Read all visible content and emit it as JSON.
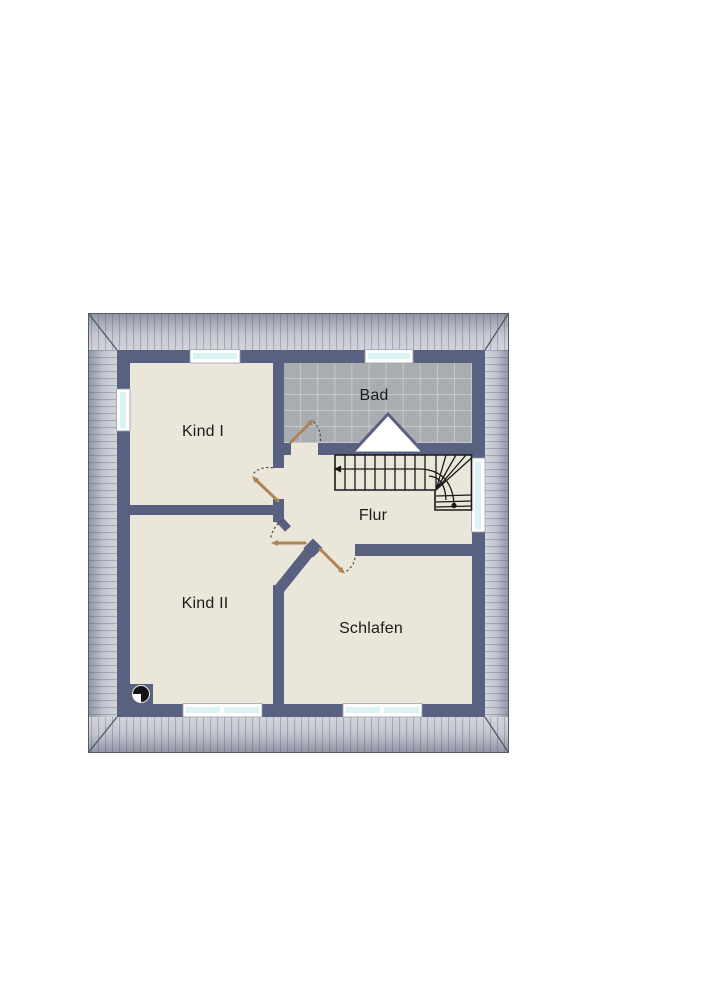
{
  "floorplan": {
    "rooms": [
      {
        "id": "kind-1",
        "label": "Kind I"
      },
      {
        "id": "bad",
        "label": "Bad"
      },
      {
        "id": "flur",
        "label": "Flur"
      },
      {
        "id": "kind-2",
        "label": "Kind II"
      },
      {
        "id": "schlafen",
        "label": "Schlafen"
      }
    ],
    "symbols": [
      "staircase-with-winder",
      "stair-direction-arrow",
      "chimney-icon",
      "door-swing",
      "window",
      "roof-overhang",
      "dormer-triangle"
    ],
    "colors": {
      "wall": "#596180",
      "floor": "#eae6da",
      "tile": "#a9acb1",
      "tile_line": "#c6c8cc",
      "window_glass": "#d9f3f5",
      "door": "#b08355",
      "stair_line": "#181818",
      "roof_dark": "#8f94a4",
      "roof_mid": "#c3c6d0",
      "roof_light": "#d3d5dc",
      "label_text": "#1b1b1b"
    }
  }
}
